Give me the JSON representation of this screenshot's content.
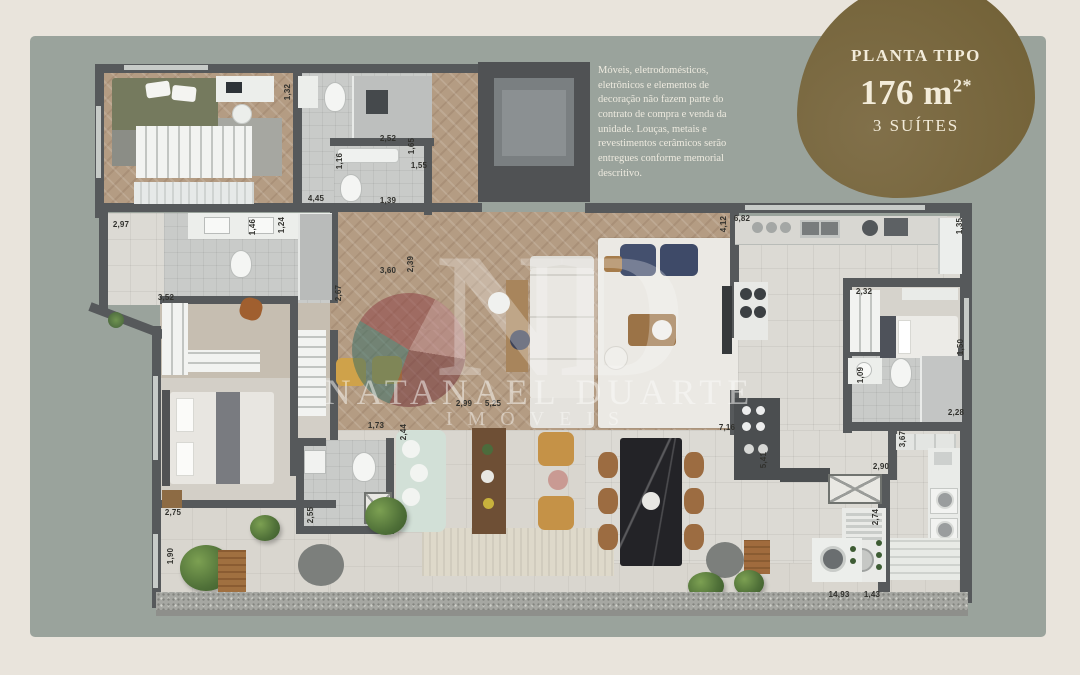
{
  "badge": {
    "title": "PLANTA TIPO",
    "area_value": "176 m",
    "area_exponent": "2*",
    "suites": "3 SUÍTES"
  },
  "disclaimer": "Móveis, eletrodomésticos, eletrônicos e elementos de decoração não fazem parte do contrato de compra e venda da unidade. Louças, metais e revestimentos cerâmicos serão entregues conforme memorial descritivo.",
  "watermark": {
    "monogram": "ND",
    "name": "NATANAEL DUARTE",
    "subtitle": "IMÓVEIS"
  },
  "colors": {
    "background": "#e9e4dc",
    "panel": "#9aa39c",
    "badge": "#766540",
    "wall": "#56595b",
    "wood_floor": "#b49c83"
  },
  "dimensions": [
    {
      "value": "2,52",
      "x": 388,
      "y": 139,
      "vertical": false
    },
    {
      "value": "1,65",
      "x": 412,
      "y": 146,
      "vertical": true
    },
    {
      "value": "1,55",
      "x": 419,
      "y": 166,
      "vertical": false
    },
    {
      "value": "1,16",
      "x": 340,
      "y": 161,
      "vertical": true
    },
    {
      "value": "1,32",
      "x": 288,
      "y": 92,
      "vertical": true
    },
    {
      "value": "4,45",
      "x": 316,
      "y": 199,
      "vertical": false
    },
    {
      "value": "1,39",
      "x": 388,
      "y": 201,
      "vertical": false
    },
    {
      "value": "2,97",
      "x": 121,
      "y": 225,
      "vertical": false
    },
    {
      "value": "1,46",
      "x": 253,
      "y": 227,
      "vertical": true
    },
    {
      "value": "1,24",
      "x": 282,
      "y": 225,
      "vertical": true
    },
    {
      "value": "3,52",
      "x": 166,
      "y": 298,
      "vertical": false
    },
    {
      "value": "2,67",
      "x": 339,
      "y": 293,
      "vertical": true
    },
    {
      "value": "2,39",
      "x": 411,
      "y": 264,
      "vertical": true
    },
    {
      "value": "3,60",
      "x": 388,
      "y": 271,
      "vertical": false
    },
    {
      "value": "2,99",
      "x": 464,
      "y": 404,
      "vertical": false
    },
    {
      "value": "5,25",
      "x": 493,
      "y": 404,
      "vertical": false
    },
    {
      "value": "1,73",
      "x": 376,
      "y": 426,
      "vertical": false
    },
    {
      "value": "2,44",
      "x": 404,
      "y": 432,
      "vertical": true
    },
    {
      "value": "6,82",
      "x": 742,
      "y": 219,
      "vertical": false
    },
    {
      "value": "4,12",
      "x": 724,
      "y": 224,
      "vertical": true
    },
    {
      "value": "1,35",
      "x": 960,
      "y": 226,
      "vertical": true
    },
    {
      "value": "2,32",
      "x": 864,
      "y": 292,
      "vertical": false
    },
    {
      "value": "1,50",
      "x": 961,
      "y": 347,
      "vertical": true
    },
    {
      "value": "1,09",
      "x": 861,
      "y": 375,
      "vertical": true
    },
    {
      "value": "2,28",
      "x": 956,
      "y": 413,
      "vertical": false
    },
    {
      "value": "3,67",
      "x": 903,
      "y": 439,
      "vertical": true
    },
    {
      "value": "2,90",
      "x": 881,
      "y": 467,
      "vertical": false
    },
    {
      "value": "7,16",
      "x": 727,
      "y": 428,
      "vertical": false
    },
    {
      "value": "5,41",
      "x": 764,
      "y": 460,
      "vertical": true
    },
    {
      "value": "2,74",
      "x": 876,
      "y": 517,
      "vertical": true
    },
    {
      "value": "2,75",
      "x": 173,
      "y": 513,
      "vertical": false
    },
    {
      "value": "2,55",
      "x": 311,
      "y": 515,
      "vertical": true
    },
    {
      "value": "1,90",
      "x": 171,
      "y": 556,
      "vertical": true
    },
    {
      "value": "14,93",
      "x": 839,
      "y": 595,
      "vertical": false
    },
    {
      "value": "1,43",
      "x": 872,
      "y": 595,
      "vertical": false
    }
  ]
}
